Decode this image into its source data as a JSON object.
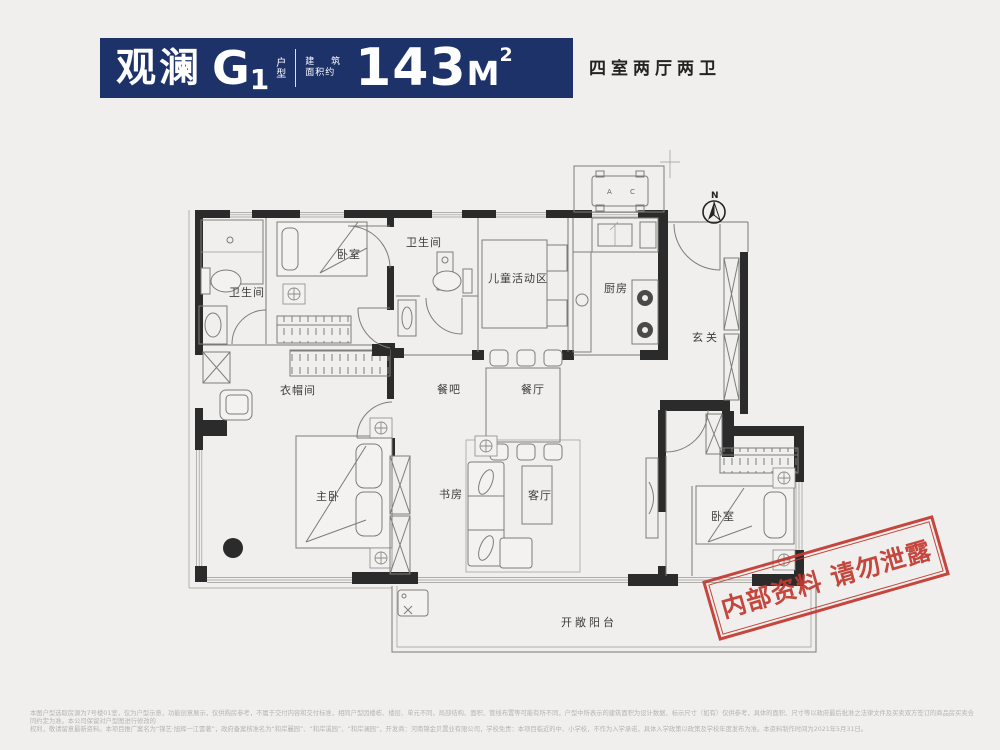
{
  "header": {
    "project_name": "观澜",
    "unit_code": "G",
    "unit_number": "1",
    "unit_label_vertical": [
      "户",
      "型"
    ],
    "area_caption_line1": "建 筑",
    "area_caption_line2": "面积约",
    "area_value": "143",
    "area_unit": "M",
    "area_superscript": "2",
    "layout_summary": "四室两厅两卫",
    "banner_color": "#1d3268"
  },
  "plan": {
    "compass_label": "N",
    "equipment_label": "A C",
    "rooms": [
      {
        "id": "bathroom-1",
        "label": "卫生间"
      },
      {
        "id": "bedroom-1",
        "label": "卧室"
      },
      {
        "id": "bathroom-2",
        "label": "卫生间"
      },
      {
        "id": "kids-activity-area",
        "label": "儿童活动区"
      },
      {
        "id": "kitchen",
        "label": "厨房"
      },
      {
        "id": "foyer",
        "label": "玄关"
      },
      {
        "id": "cloakroom",
        "label": "衣帽间"
      },
      {
        "id": "dining-bar",
        "label": "餐吧"
      },
      {
        "id": "dining-room",
        "label": "餐厅"
      },
      {
        "id": "master-bedroom",
        "label": "主卧"
      },
      {
        "id": "study",
        "label": "书房"
      },
      {
        "id": "living-room",
        "label": "客厅"
      },
      {
        "id": "bedroom-2",
        "label": "卧室"
      },
      {
        "id": "open-balcony",
        "label": "开敞阳台"
      }
    ],
    "stamp": {
      "text": "内部资料 请勿泄露",
      "color": "#c13a30"
    }
  },
  "footer": {
    "disclaimer_line1": "本图户型选取房源为7号楼01室，仅为户型示意，功能创意展示，仅供购房参考，不属于交付内容和交付标准，相同户型因楼栋、楼层、单元不同，局部结构、面积、管线布置等可能有所不同，户型中所表示的建筑面积为设计数据，标示尺寸（如有）仅供参考，具体的面积、尺寸等以政府最后批准之法律文件及买卖双方签订的商品房买卖合同约定为准。本公司保留对户型图进行修改的",
    "disclaimer_line2": "权利，敬请留意最新资料。本项目推广案名为“锦艺·旭辉一江雲著”，政府备案核准名为“和岸麗园”、“和岸溪园”、“和岸澜园”，开发商：河南锦金贝置业有限公司，学校免责：本项目临近的中、小学校，不作为入学承诺，具体入学政策以政策及学校年度发布为准。本资料制作时间为2021年5月31日。"
  }
}
